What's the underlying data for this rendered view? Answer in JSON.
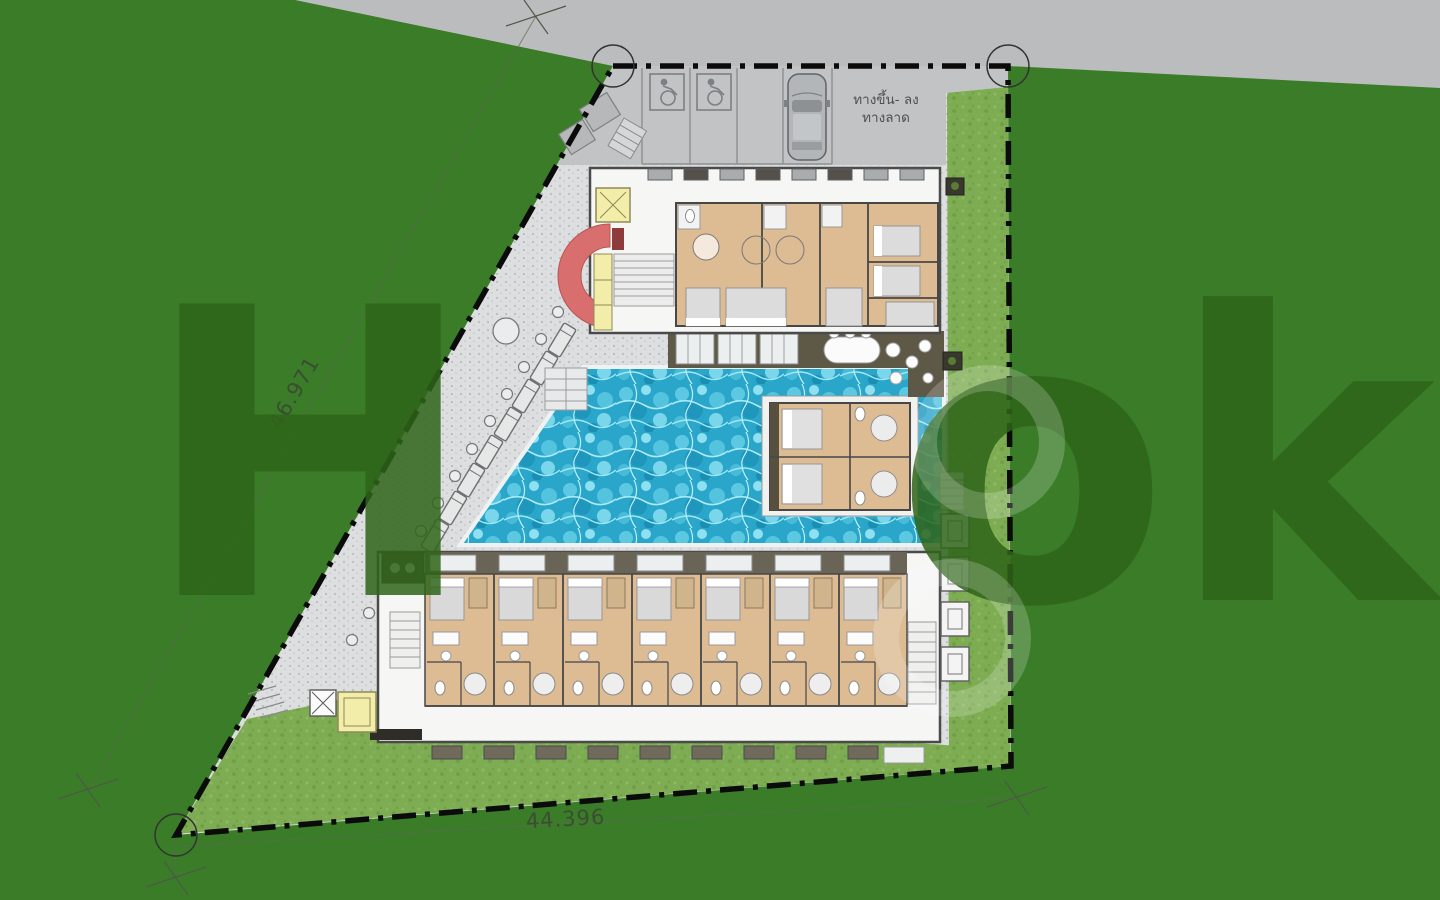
{
  "site_plan": {
    "title": "resort-ground-floor-site-plan",
    "dimensions": {
      "left_boundary": "46.971",
      "bottom_boundary": "44.396"
    },
    "ramp_label": {
      "line1": "ทางขึ้น- ลง",
      "line2": "ทางลาด"
    },
    "watermark": {
      "left": "H",
      "right": "ok"
    },
    "parking": {
      "handicap_stalls": 2,
      "car_count": 1
    },
    "rooms": {
      "bottom_row_rooms": 7,
      "pool_access_rooms": 2,
      "top_block_rooms": 4
    },
    "pool": {
      "loungers": 8,
      "umbrellas": 1
    },
    "colors": {
      "field_green": "#3a7c27",
      "lawn_green": "#7dac52",
      "road_gray": "#babcbd",
      "hardscape": "#dddedf",
      "pool_blue": "#2aa6cb",
      "room_floor_tan": "#ddbb93",
      "deck_brown": "#5e5847",
      "feature_red": "#d96e6e",
      "lift_yellow": "#f2eda9",
      "boundary_black": "#0b0b0b"
    }
  }
}
